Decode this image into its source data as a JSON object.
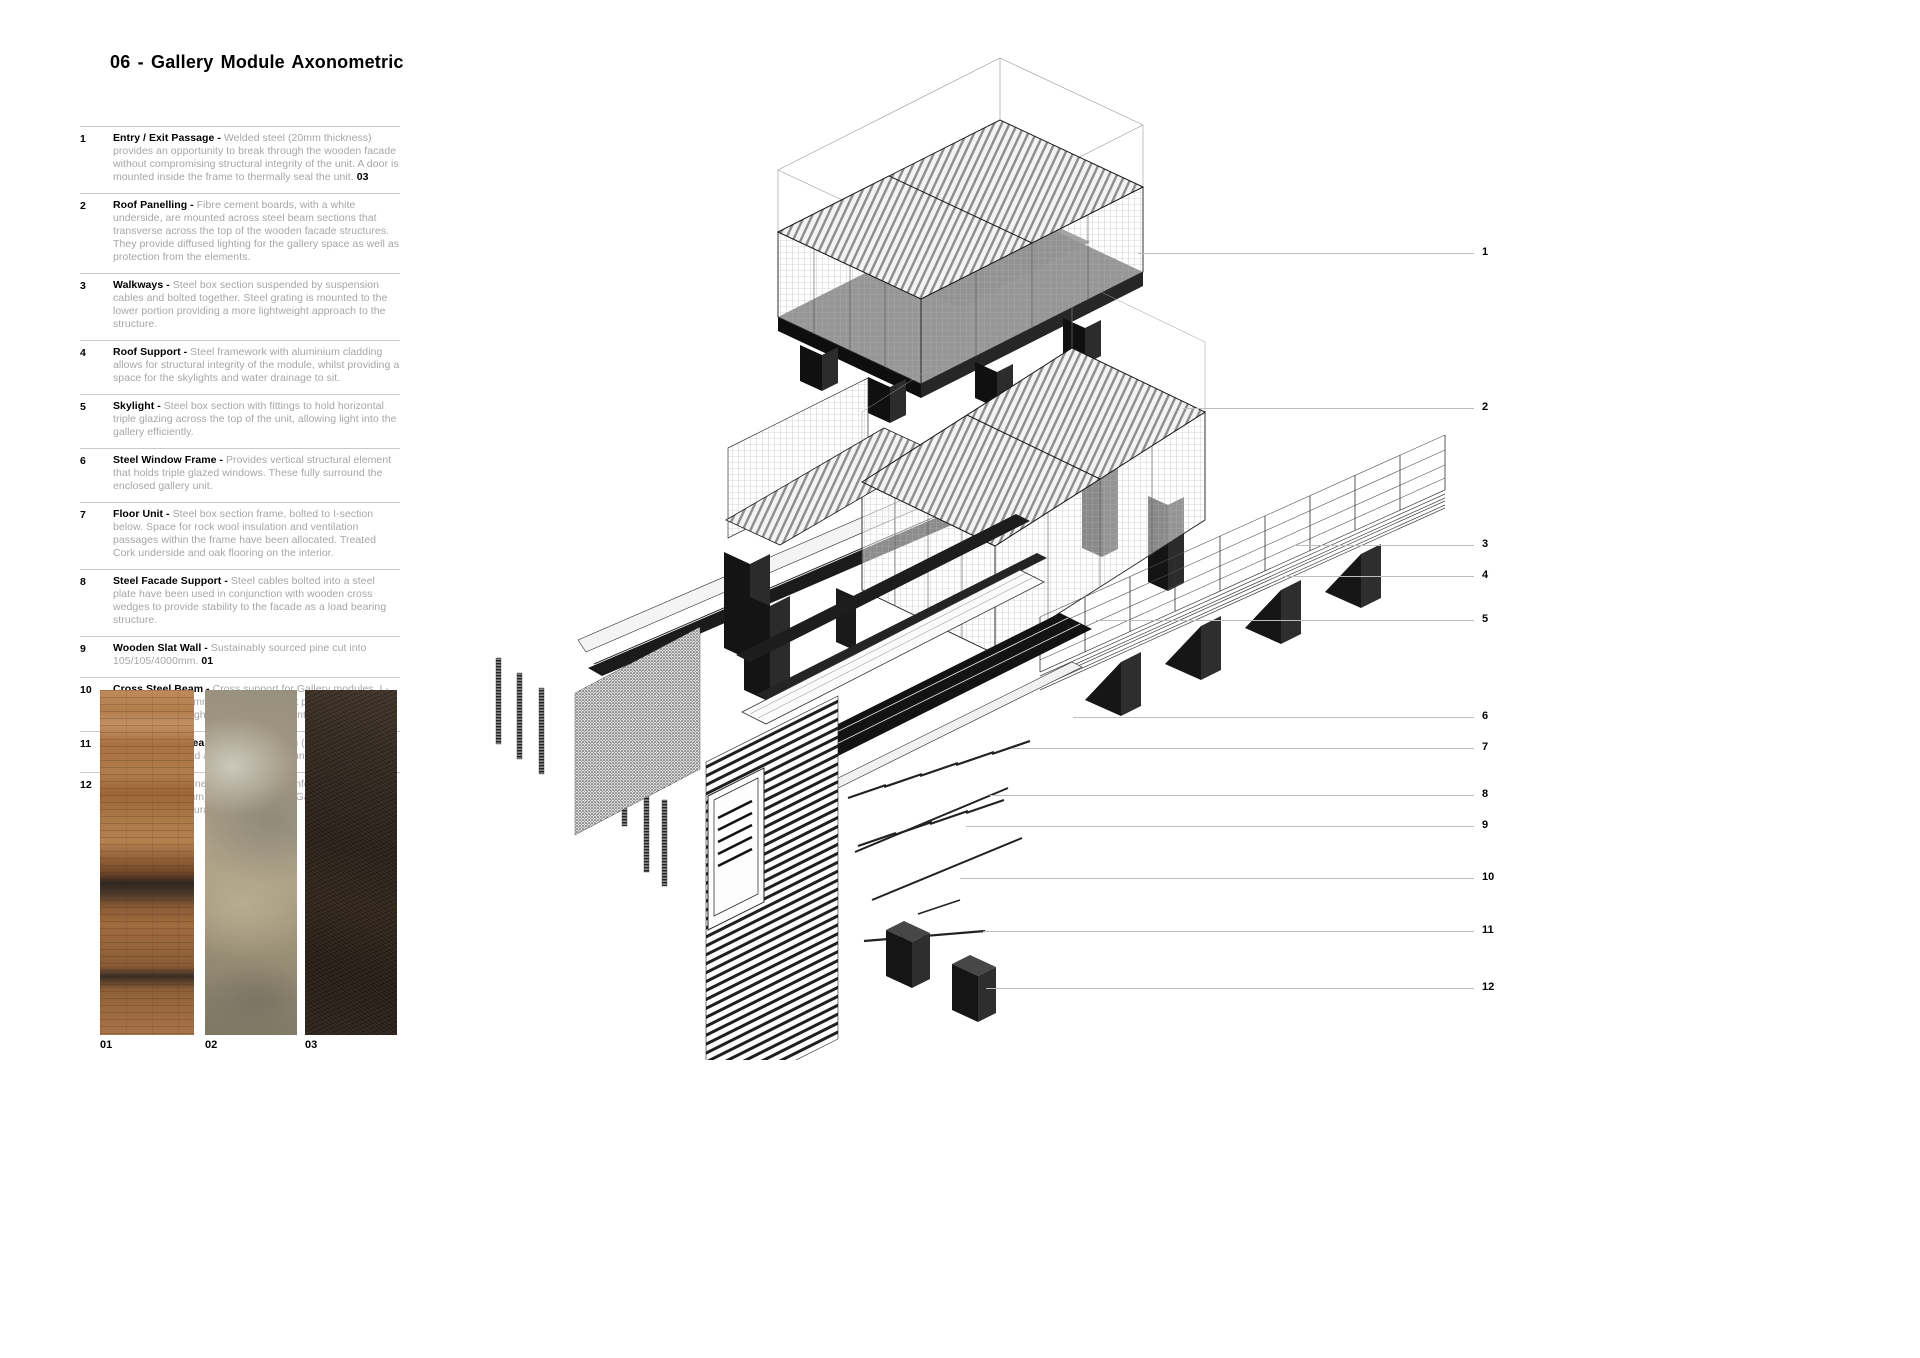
{
  "page": {
    "title": "06 - Gallery Module  Axonometric"
  },
  "legend": {
    "items": [
      {
        "num": "1",
        "title": "Entry / Exit Passage - ",
        "description": "Welded steel (20mm thickness) provides an opportunity to break through the wooden facade without compromising structural integrity of the unit. A door is mounted inside the frame to thermally seal the unit. ",
        "ref": "03"
      },
      {
        "num": "2",
        "title": "Roof Panelling - ",
        "description": "Fibre cement boards, with a white underside, are mounted across steel beam sections that transverse across the top of the wooden facade structures. They provide diffused lighting for the gallery space as well as protection from the elements.",
        "ref": ""
      },
      {
        "num": "3",
        "title": "Walkways - ",
        "description": "Steel box section suspended by suspension cables and bolted together. Steel grating is mounted to the lower portion providing a more lightweight approach to the structure.",
        "ref": ""
      },
      {
        "num": "4",
        "title": "Roof Support - ",
        "description": "Steel framework with aluminium cladding allows for structural integrity of the module, whilst providing a space for the skylights and water drainage to sit.",
        "ref": ""
      },
      {
        "num": "5",
        "title": "Skylight - ",
        "description": "Steel box section with fittings to hold horizontal triple glazing across the top of the unit, allowing light into the gallery efficiently.",
        "ref": ""
      },
      {
        "num": "6",
        "title": "Steel Window Frame - ",
        "description": "Provides vertical structural element that holds triple glazed windows. These fully surround the enclosed gallery unit.",
        "ref": ""
      },
      {
        "num": "7",
        "title": "Floor Unit - ",
        "description": "Steel box section frame, bolted to I-section below. Space for rock wool insulation and ventilation passages within the frame have been allocated. Treated Cork underside and oak flooring on the interior.",
        "ref": ""
      },
      {
        "num": "8",
        "title": "Steel Facade Support - ",
        "description": "Steel cables bolted into a steel plate have been used in conjunction with wooden cross wedges to provide stability to the facade as a load bearing structure.",
        "ref": ""
      },
      {
        "num": "9",
        "title": "Wooden Slat Wall - ",
        "description": "Sustainably sourced pine cut into 105/105/4000mm. ",
        "ref": "01"
      },
      {
        "num": "10",
        "title": "Cross Steel Beam - ",
        "description": "Cross support for Gallery modules, I - Section (250/160mm)  holding the direct pressure then transferring through bolted steel end joint.",
        "ref": ""
      },
      {
        "num": "11",
        "title": "Steal Support Beam - ",
        "description": "Steel I - Section (250/160mm) spreading the load across the stone foundations below. ",
        "ref": "03"
      },
      {
        "num": "12",
        "title": "Block Stone - ",
        "description": "Mined in the UK by Stamford Stone Co, (800/1100/2400mm) blocks raising the Gallery's and providing a structural foundation. ",
        "ref": "02"
      }
    ]
  },
  "materials": {
    "swatches": [
      {
        "label": "01",
        "name": "wood-texture"
      },
      {
        "label": "02",
        "name": "stone-texture"
      },
      {
        "label": "03",
        "name": "steel-texture"
      }
    ]
  },
  "callouts": [
    {
      "n": "1"
    },
    {
      "n": "2"
    },
    {
      "n": "3"
    },
    {
      "n": "4"
    },
    {
      "n": "5"
    },
    {
      "n": "6"
    },
    {
      "n": "7"
    },
    {
      "n": "8"
    },
    {
      "n": "9"
    },
    {
      "n": "10"
    },
    {
      "n": "11"
    },
    {
      "n": "12"
    }
  ],
  "colors": {
    "background": "#ffffff",
    "text": "#000000",
    "muted_text": "#a6a6a6",
    "rule": "#c9c9c9",
    "leader": "#bdbdbd",
    "drawing_dark": "#161616"
  }
}
